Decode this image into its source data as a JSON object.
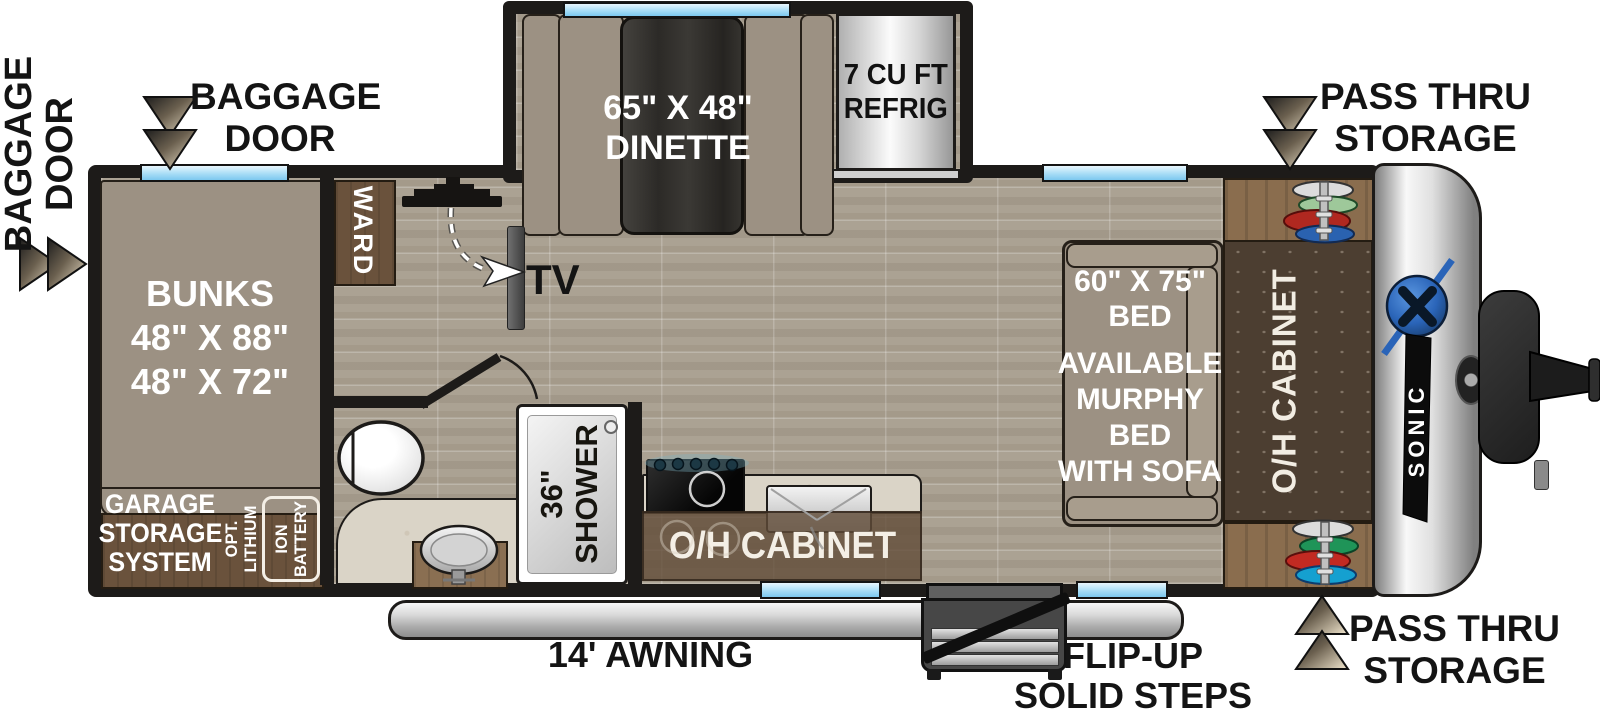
{
  "labels": {
    "baggage_door_side": [
      "BAGGAGE",
      "DOOR"
    ],
    "baggage_door_top": [
      "BAGGAGE",
      "DOOR"
    ],
    "pass_thru_top": [
      "PASS THRU",
      "STORAGE"
    ],
    "pass_thru_bottom": [
      "PASS THRU",
      "STORAGE"
    ],
    "awning": "14' AWNING",
    "steps": [
      "FLIP-UP",
      "SOLID STEPS"
    ],
    "tv": "TV"
  },
  "rooms": {
    "bunks": [
      "BUNKS",
      "48\" X 88\"",
      "48\" X 72\""
    ],
    "garage": [
      "GARAGE",
      "STORAGE",
      "SYSTEM"
    ],
    "battery_opt": [
      "OPT.",
      "LITHIUM"
    ],
    "battery_box": [
      "ION",
      "BATTERY"
    ],
    "ward": "WARD",
    "dinette": [
      "65\" X 48\"",
      "DINETTE"
    ],
    "refrigerator": [
      "7 CU FT",
      "REFRIG"
    ],
    "shower": [
      "36\"",
      "SHOWER"
    ],
    "kitchen_overhead": "O/H CABINET",
    "bed": [
      "60\" X 75\"",
      "BED"
    ],
    "bed_option": [
      "AVAILABLE",
      "MURPHY",
      "BED",
      "WITH SOFA"
    ],
    "right_overhead": "O/H CABINET"
  },
  "brand": {
    "model": "SONIC"
  },
  "colors": {
    "wall": "#1d1b19",
    "floor": "#aba293",
    "cushion": "#9c9183",
    "cabinet_brown": "#6a523c",
    "wood": "#8a6d4e",
    "dark_cabinet": "#4c3e31",
    "window": "#bfe4f7",
    "logo_blue": "#2a64b8"
  }
}
